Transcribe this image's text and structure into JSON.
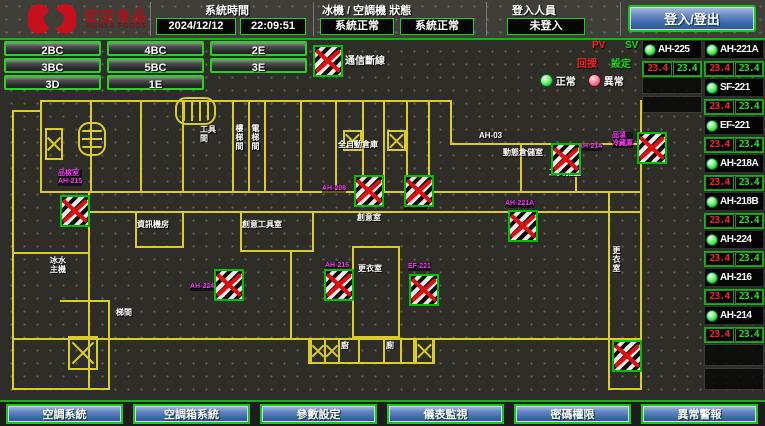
{
  "header": {
    "logo": {
      "brand": "宏亞食品",
      "brand_sub": "HUNYA FOODS"
    },
    "system_time": {
      "label": "系統時間",
      "date": "2024/12/12",
      "time": "22:09:51"
    },
    "machine_status": {
      "label": "冰機 / 空調機 狀態",
      "chiller": "系統正常",
      "ahu": "系統正常"
    },
    "login": {
      "label": "登入人員",
      "value": "未登入",
      "button": "登入/登出"
    }
  },
  "floor_nav": {
    "buttons": [
      "2BC",
      "4BC",
      "2E",
      "3BC",
      "5BC",
      "3E",
      "3D",
      "1E"
    ]
  },
  "legend": {
    "comm_lost": "通信斷線",
    "pv": "PV",
    "sv": "SV",
    "pv_desc": "回授",
    "sv_desc": "設定",
    "normal": "正常",
    "abnormal": "異常"
  },
  "units": [
    {
      "name": "AH-225",
      "pv": "23.4",
      "sv": "23.4"
    },
    {
      "name": "AH-221A",
      "pv": "23.4",
      "sv": "23.4"
    },
    {
      "name": "SF-221",
      "pv": "23.4",
      "sv": "23.4"
    },
    {
      "name": "EF-221",
      "pv": "23.4",
      "sv": "23.4"
    },
    {
      "name": "AH-218A",
      "pv": "23.4",
      "sv": "23.4"
    },
    {
      "name": "AH-218B",
      "pv": "23.4",
      "sv": "23.4"
    },
    {
      "name": "AH-224",
      "pv": "23.4",
      "sv": "23.4"
    },
    {
      "name": "AH-216",
      "pv": "23.4",
      "sv": "23.4"
    },
    {
      "name": "AH-214",
      "pv": "23.4",
      "sv": "23.4"
    }
  ],
  "floor_plan": {
    "rooms": [
      {
        "x": 200,
        "y": 125,
        "lines": [
          "工具",
          "間"
        ]
      },
      {
        "x": 235,
        "y": 124,
        "lines": [
          "樓梯間"
        ],
        "v": true
      },
      {
        "x": 251,
        "y": 124,
        "lines": [
          "電梯間"
        ],
        "v": true
      },
      {
        "x": 338,
        "y": 140,
        "lines": [
          "全自動倉庫"
        ]
      },
      {
        "x": 479,
        "y": 131,
        "lines": [
          "AH-03"
        ]
      },
      {
        "x": 503,
        "y": 148,
        "lines": [
          "動態倉儲室"
        ]
      },
      {
        "x": 549,
        "y": 168,
        "lines": [
          "工具機室"
        ]
      },
      {
        "x": 137,
        "y": 220,
        "lines": [
          "資訊機房"
        ]
      },
      {
        "x": 242,
        "y": 220,
        "lines": [
          "創意工具室"
        ]
      },
      {
        "x": 357,
        "y": 213,
        "lines": [
          "創意室"
        ]
      },
      {
        "x": 358,
        "y": 264,
        "lines": [
          "更衣室"
        ]
      },
      {
        "x": 612,
        "y": 246,
        "lines": [
          "更衣室"
        ],
        "v": true
      },
      {
        "x": 50,
        "y": 256,
        "lines": [
          "冰水",
          "主機"
        ]
      },
      {
        "x": 116,
        "y": 308,
        "lines": [
          "梯間"
        ]
      },
      {
        "x": 341,
        "y": 341,
        "lines": [
          "廚"
        ]
      },
      {
        "x": 386,
        "y": 341,
        "lines": [
          "廁"
        ]
      }
    ],
    "tags": [
      {
        "x": 58,
        "y": 170,
        "lines": [
          "品檢室",
          "AH-215"
        ]
      },
      {
        "x": 322,
        "y": 185,
        "lines": [
          "AH-208"
        ]
      },
      {
        "x": 404,
        "y": 202,
        "lines": [
          "SF-221"
        ]
      },
      {
        "x": 578,
        "y": 143,
        "lines": [
          "AH-214"
        ]
      },
      {
        "x": 612,
        "y": 132,
        "lines": [
          "品溫",
          "冷藏庫"
        ]
      },
      {
        "x": 505,
        "y": 200,
        "lines": [
          "AH-221A"
        ]
      },
      {
        "x": 190,
        "y": 283,
        "lines": [
          "AH-224"
        ]
      },
      {
        "x": 325,
        "y": 262,
        "lines": [
          "AH-216"
        ]
      },
      {
        "x": 408,
        "y": 263,
        "lines": [
          "EF-221"
        ]
      }
    ],
    "markers": [
      {
        "x": 60,
        "y": 195
      },
      {
        "x": 354,
        "y": 175
      },
      {
        "x": 404,
        "y": 175
      },
      {
        "x": 551,
        "y": 143
      },
      {
        "x": 637,
        "y": 132
      },
      {
        "x": 508,
        "y": 210
      },
      {
        "x": 214,
        "y": 269
      },
      {
        "x": 324,
        "y": 269
      },
      {
        "x": 409,
        "y": 274
      },
      {
        "x": 612,
        "y": 340
      }
    ]
  },
  "bottom_nav": [
    "空調系統",
    "空調箱系統",
    "參數設定",
    "儀表監視",
    "密碼權限",
    "異常警報"
  ]
}
